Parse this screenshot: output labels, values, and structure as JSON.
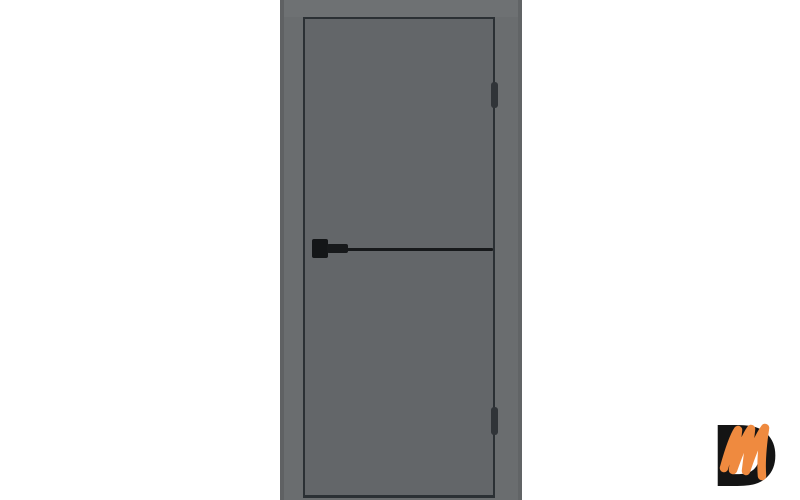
{
  "page": {
    "background_color": "#ffffff"
  },
  "door": {
    "subject": "Gray interior door with black edge trim, black horizontal molding, black lever handle and two black hinges",
    "wall_color": "#6a6d6f",
    "frame_head_color": "#6e7173",
    "leaf_color": "#636669",
    "edge_trim_color": "#2b3034",
    "molding_color": "#17191b",
    "handle_rosette_color": "#141618",
    "handle_lever_color": "#17191b",
    "hinge_color": "#303438"
  },
  "watermark": {
    "letter_d": "D",
    "d_color": "#141414",
    "m_color": "#ef8a3f"
  }
}
